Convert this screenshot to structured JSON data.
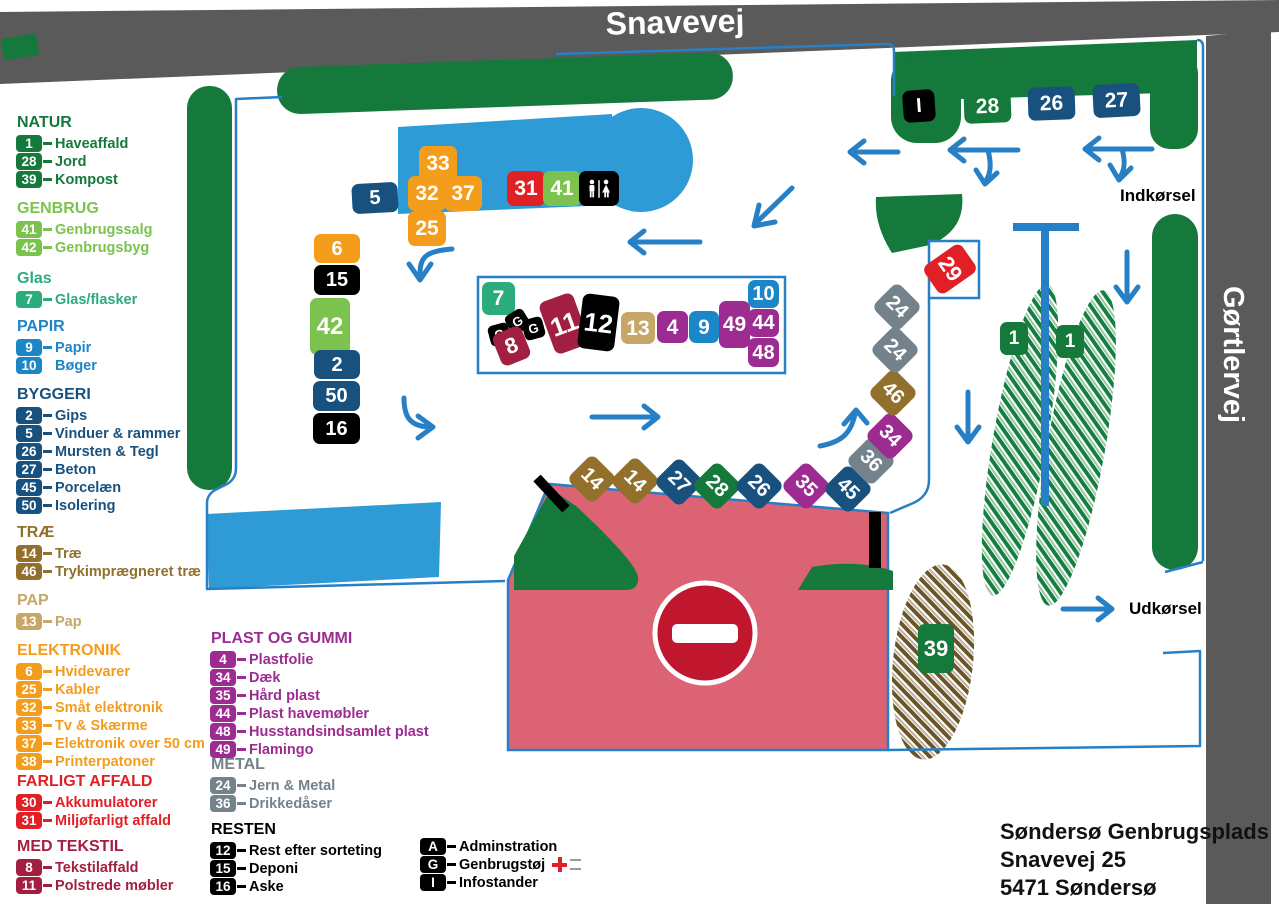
{
  "colors": {
    "green": "#15793B",
    "lightgreen": "#7CC24F",
    "teal": "#2BAC7C",
    "blue": "#1B86C8",
    "darkblue": "#19517E",
    "gold": "#92702B",
    "tan": "#C7A667",
    "orange": "#F49C1C",
    "red": "#E12026",
    "maroon": "#A31F41",
    "purple": "#9D2C92",
    "gray": "#74828B",
    "black": "#000000",
    "road_gray": "#5A5A5A",
    "pink": "#DC6374",
    "path_blue": "#2780C5",
    "building_blue": "#2E9BD6",
    "noentry_red": "#C0172F",
    "brown": "#6B5426"
  },
  "roads": {
    "top_label": "Snavevej",
    "right_label": "Gørtlervej"
  },
  "map_labels": {
    "entrance": "Indkørsel",
    "exit": "Udkørsel"
  },
  "address": {
    "line1": "Søndersø Genbrugsplads",
    "line2": "Snavevej 25",
    "line3": "5471 Søndersø"
  },
  "legend": {
    "groups": [
      {
        "title": "NATUR",
        "color": "green",
        "x": 16,
        "y": 114,
        "items": [
          [
            "1",
            "Haveaffald"
          ],
          [
            "28",
            "Jord"
          ],
          [
            "39",
            "Kompost"
          ]
        ]
      },
      {
        "title": "GENBRUG",
        "color": "lightgreen",
        "x": 16,
        "y": 200,
        "items": [
          [
            "41",
            "Genbrugssalg"
          ],
          [
            "42",
            "Genbrugsbyg"
          ]
        ]
      },
      {
        "title": "Glas",
        "color": "teal",
        "x": 16,
        "y": 270,
        "items": [
          [
            "7",
            "Glas/flasker"
          ]
        ]
      },
      {
        "title": "PAPIR",
        "color": "blue",
        "x": 16,
        "y": 318,
        "items": [
          [
            "9",
            "Papir"
          ],
          [
            "10",
            "Bøger",
            "nodash"
          ]
        ]
      },
      {
        "title": "BYGGERI",
        "color": "darkblue",
        "x": 16,
        "y": 386,
        "items": [
          [
            "2",
            "Gips"
          ],
          [
            "5",
            "Vinduer & rammer"
          ],
          [
            "26",
            "Mursten & Tegl"
          ],
          [
            "27",
            "Beton"
          ],
          [
            "45",
            "Porcelæn"
          ],
          [
            "50",
            "Isolering"
          ]
        ]
      },
      {
        "title": "TRÆ",
        "color": "gold",
        "x": 16,
        "y": 524,
        "items": [
          [
            "14",
            "Træ"
          ],
          [
            "46",
            "Trykimprægneret træ"
          ]
        ]
      },
      {
        "title": "PAP",
        "color": "tan",
        "x": 16,
        "y": 592,
        "items": [
          [
            "13",
            "Pap"
          ]
        ]
      },
      {
        "title": "ELEKTRONIK",
        "color": "orange",
        "x": 16,
        "y": 642,
        "items": [
          [
            "6",
            "Hvidevarer"
          ],
          [
            "25",
            "Kabler"
          ],
          [
            "32",
            "Småt elektronik"
          ],
          [
            "33",
            "Tv & Skærme"
          ],
          [
            "37",
            "Elektronik over 50 cm"
          ],
          [
            "38",
            "Printerpatoner"
          ]
        ]
      },
      {
        "title": "FARLIGT AFFALD",
        "color": "red",
        "x": 16,
        "y": 773,
        "items": [
          [
            "30",
            "Akkumulatorer"
          ],
          [
            "31",
            "Miljøfarligt affald"
          ]
        ]
      },
      {
        "title": "MED TEKSTIL",
        "color": "maroon",
        "x": 16,
        "y": 838,
        "items": [
          [
            "8",
            "Tekstilaffald"
          ],
          [
            "11",
            "Polstrede møbler"
          ]
        ]
      },
      {
        "title": "PLAST OG GUMMI",
        "color": "purple",
        "x": 210,
        "y": 630,
        "items": [
          [
            "4",
            "Plastfolie"
          ],
          [
            "34",
            "Dæk"
          ],
          [
            "35",
            "Hård plast"
          ],
          [
            "44",
            "Plast havemøbler"
          ],
          [
            "48",
            "Husstandsindsamlet plast"
          ],
          [
            "49",
            "Flamingo"
          ]
        ]
      },
      {
        "title": "METAL",
        "color": "gray",
        "x": 210,
        "y": 756,
        "items": [
          [
            "24",
            "Jern & Metal"
          ],
          [
            "36",
            "Drikkedåser"
          ]
        ]
      },
      {
        "title": "RESTEN",
        "color": "black",
        "x": 210,
        "y": 821,
        "items": [
          [
            "12",
            "Rest efter sorteting"
          ],
          [
            "15",
            "Deponi"
          ],
          [
            "16",
            "Aske"
          ]
        ]
      },
      {
        "title": "",
        "color": "black",
        "x": 420,
        "y": 838,
        "items": [
          [
            "A",
            "Adminstration"
          ],
          [
            "G",
            "Genbrugstøj",
            "cross"
          ],
          [
            "I",
            "Infostander"
          ]
        ]
      }
    ]
  },
  "badges": [
    {
      "label": "I",
      "color": "black",
      "x": 903,
      "y": 90,
      "w": 32,
      "h": 32,
      "r": -4,
      "fs": 20
    },
    {
      "label": "28",
      "color": "green",
      "x": 964,
      "y": 90,
      "w": 47,
      "h": 33,
      "r": -2,
      "fs": 21
    },
    {
      "label": "26",
      "color": "darkblue",
      "x": 1028,
      "y": 87,
      "w": 47,
      "h": 33,
      "r": -2,
      "fs": 21
    },
    {
      "label": "27",
      "color": "darkblue",
      "x": 1093,
      "y": 84,
      "w": 47,
      "h": 33,
      "r": -3,
      "fs": 21
    },
    {
      "label": "5",
      "color": "darkblue",
      "x": 352,
      "y": 183,
      "w": 46,
      "h": 30,
      "r": -3,
      "fs": 20
    },
    {
      "label": "33",
      "color": "orange",
      "x": 419,
      "y": 146,
      "w": 38,
      "h": 35,
      "fs": 21
    },
    {
      "label": "32",
      "color": "orange",
      "x": 408,
      "y": 176,
      "w": 38,
      "h": 35,
      "fs": 21
    },
    {
      "label": "37",
      "color": "orange",
      "x": 444,
      "y": 176,
      "w": 38,
      "h": 35,
      "fs": 21
    },
    {
      "label": "25",
      "color": "orange",
      "x": 408,
      "y": 211,
      "w": 38,
      "h": 35,
      "fs": 21
    },
    {
      "label": "31",
      "color": "red",
      "x": 507,
      "y": 171,
      "w": 38,
      "h": 35,
      "fs": 21
    },
    {
      "label": "41",
      "color": "lightgreen",
      "x": 543,
      "y": 171,
      "w": 38,
      "h": 35,
      "fs": 21
    },
    {
      "type": "restroom",
      "color": "black",
      "x": 579,
      "y": 171,
      "w": 40,
      "h": 35
    },
    {
      "label": "6",
      "color": "orange",
      "x": 314,
      "y": 234,
      "w": 46,
      "h": 29,
      "fs": 20
    },
    {
      "label": "15",
      "color": "black",
      "x": 314,
      "y": 265,
      "w": 46,
      "h": 30,
      "fs": 20
    },
    {
      "label": "42",
      "color": "lightgreen",
      "x": 310,
      "y": 298,
      "w": 40,
      "h": 57,
      "fs": 24
    },
    {
      "label": "2",
      "color": "darkblue",
      "x": 314,
      "y": 350,
      "w": 46,
      "h": 29,
      "fs": 20
    },
    {
      "label": "50",
      "color": "darkblue",
      "x": 313,
      "y": 381,
      "w": 47,
      "h": 30,
      "fs": 20
    },
    {
      "label": "16",
      "color": "black",
      "x": 313,
      "y": 413,
      "w": 47,
      "h": 31,
      "fs": 20
    },
    {
      "label": "7",
      "color": "teal",
      "x": 482,
      "y": 282,
      "w": 33,
      "h": 33,
      "fs": 21
    },
    {
      "label": "G",
      "color": "black",
      "x": 489,
      "y": 324,
      "w": 21,
      "h": 21,
      "r": -15,
      "fs": 13
    },
    {
      "label": "G",
      "color": "black",
      "x": 507,
      "y": 311,
      "w": 21,
      "h": 21,
      "r": -32,
      "fs": 13
    },
    {
      "label": "G",
      "color": "black",
      "x": 523,
      "y": 318,
      "w": 21,
      "h": 21,
      "r": -15,
      "fs": 13
    },
    {
      "label": "8",
      "color": "maroon",
      "x": 496,
      "y": 329,
      "w": 31,
      "h": 34,
      "r": -22,
      "fs": 22
    },
    {
      "label": "11",
      "color": "maroon",
      "x": 546,
      "y": 296,
      "w": 36,
      "h": 55,
      "r": -20,
      "fs": 26
    },
    {
      "label": "12",
      "color": "black",
      "x": 580,
      "y": 295,
      "w": 37,
      "h": 55,
      "r": 7,
      "fs": 26
    },
    {
      "label": "13",
      "color": "tan",
      "x": 621,
      "y": 312,
      "w": 34,
      "h": 32,
      "fs": 21
    },
    {
      "label": "4",
      "color": "purple",
      "x": 657,
      "y": 311,
      "w": 31,
      "h": 32,
      "fs": 21
    },
    {
      "label": "9",
      "color": "blue",
      "x": 689,
      "y": 311,
      "w": 30,
      "h": 32,
      "fs": 21
    },
    {
      "label": "49",
      "color": "purple",
      "x": 719,
      "y": 301,
      "w": 31,
      "h": 47,
      "fs": 21
    },
    {
      "label": "10",
      "color": "blue",
      "x": 748,
      "y": 280,
      "w": 31,
      "h": 28,
      "fs": 20
    },
    {
      "label": "44",
      "color": "purple",
      "x": 748,
      "y": 309,
      "w": 31,
      "h": 28,
      "fs": 20
    },
    {
      "label": "48",
      "color": "purple",
      "x": 748,
      "y": 338,
      "w": 31,
      "h": 29,
      "fs": 20
    },
    {
      "label": "14",
      "color": "gold",
      "x": 574,
      "y": 461,
      "w": 36,
      "h": 36,
      "r": 45,
      "fs": 20
    },
    {
      "label": "14",
      "color": "gold",
      "x": 617,
      "y": 463,
      "w": 36,
      "h": 36,
      "r": 45,
      "fs": 20
    },
    {
      "label": "27",
      "color": "darkblue",
      "x": 661,
      "y": 464,
      "w": 36,
      "h": 36,
      "r": 45,
      "fs": 20
    },
    {
      "label": "28",
      "color": "green",
      "x": 699,
      "y": 468,
      "w": 36,
      "h": 36,
      "r": 45,
      "fs": 20
    },
    {
      "label": "26",
      "color": "darkblue",
      "x": 741,
      "y": 468,
      "w": 36,
      "h": 36,
      "r": 45,
      "fs": 20
    },
    {
      "label": "35",
      "color": "purple",
      "x": 788,
      "y": 468,
      "w": 36,
      "h": 36,
      "r": 45,
      "fs": 20
    },
    {
      "label": "45",
      "color": "darkblue",
      "x": 830,
      "y": 471,
      "w": 36,
      "h": 36,
      "r": 45,
      "fs": 20
    },
    {
      "label": "36",
      "color": "gray",
      "x": 853,
      "y": 443,
      "w": 36,
      "h": 36,
      "r": 45,
      "fs": 20
    },
    {
      "label": "34",
      "color": "purple",
      "x": 872,
      "y": 418,
      "w": 36,
      "h": 36,
      "r": 45,
      "fs": 20
    },
    {
      "label": "46",
      "color": "gold",
      "x": 875,
      "y": 375,
      "w": 36,
      "h": 36,
      "r": 45,
      "fs": 20
    },
    {
      "label": "24",
      "color": "gray",
      "x": 877,
      "y": 332,
      "w": 36,
      "h": 36,
      "r": 45,
      "fs": 20
    },
    {
      "label": "24",
      "color": "gray",
      "x": 879,
      "y": 289,
      "w": 36,
      "h": 36,
      "r": 45,
      "fs": 20
    },
    {
      "label": "29",
      "color": "red",
      "x": 933,
      "y": 246,
      "w": 34,
      "h": 46,
      "r": 55,
      "fs": 22
    },
    {
      "label": "1",
      "color": "green",
      "x": 1000,
      "y": 322,
      "w": 28,
      "h": 33,
      "fs": 19
    },
    {
      "label": "1",
      "color": "green",
      "x": 1056,
      "y": 325,
      "w": 28,
      "h": 33,
      "fs": 19
    },
    {
      "label": "39",
      "color": "green",
      "x": 918,
      "y": 624,
      "w": 36,
      "h": 49,
      "fs": 22
    }
  ]
}
